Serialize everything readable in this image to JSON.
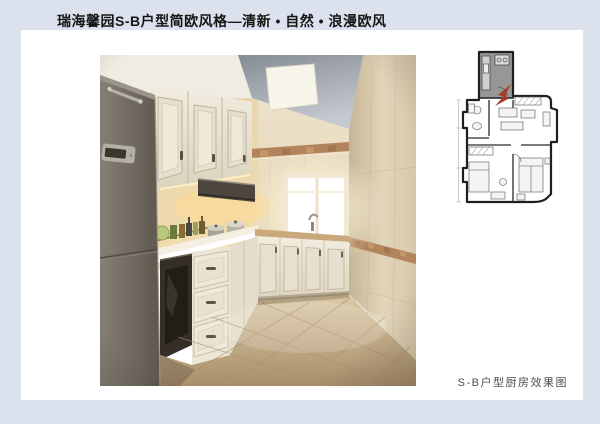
{
  "page": {
    "background_color": "#dbe2ee",
    "paper_color": "#ffffff"
  },
  "header": {
    "title": "瑞海馨园S-B户型简欧风格—清新 • 自然 • 浪漫欧风"
  },
  "photo": {
    "description": "kitchen-interior-rendering",
    "palette": {
      "ceiling_gray": "#8d939c",
      "wall_beige": "#d9caab",
      "cabinet_cream": "#ece6d6",
      "counter_white": "#f4efe1",
      "fridge_gray": "#6f685f",
      "floor_tan": "#c2ab87",
      "trim_brown": "#b2845c",
      "window_glow": "#ffffff"
    }
  },
  "floor_plan": {
    "description": "apartment-floor-plan",
    "highlight_room": "kitchen",
    "highlight_color": "#979797",
    "arrow_color": "#a83a22",
    "line_color": "#1f1f1f"
  },
  "caption": {
    "text": "S-B户型厨房效果图"
  }
}
